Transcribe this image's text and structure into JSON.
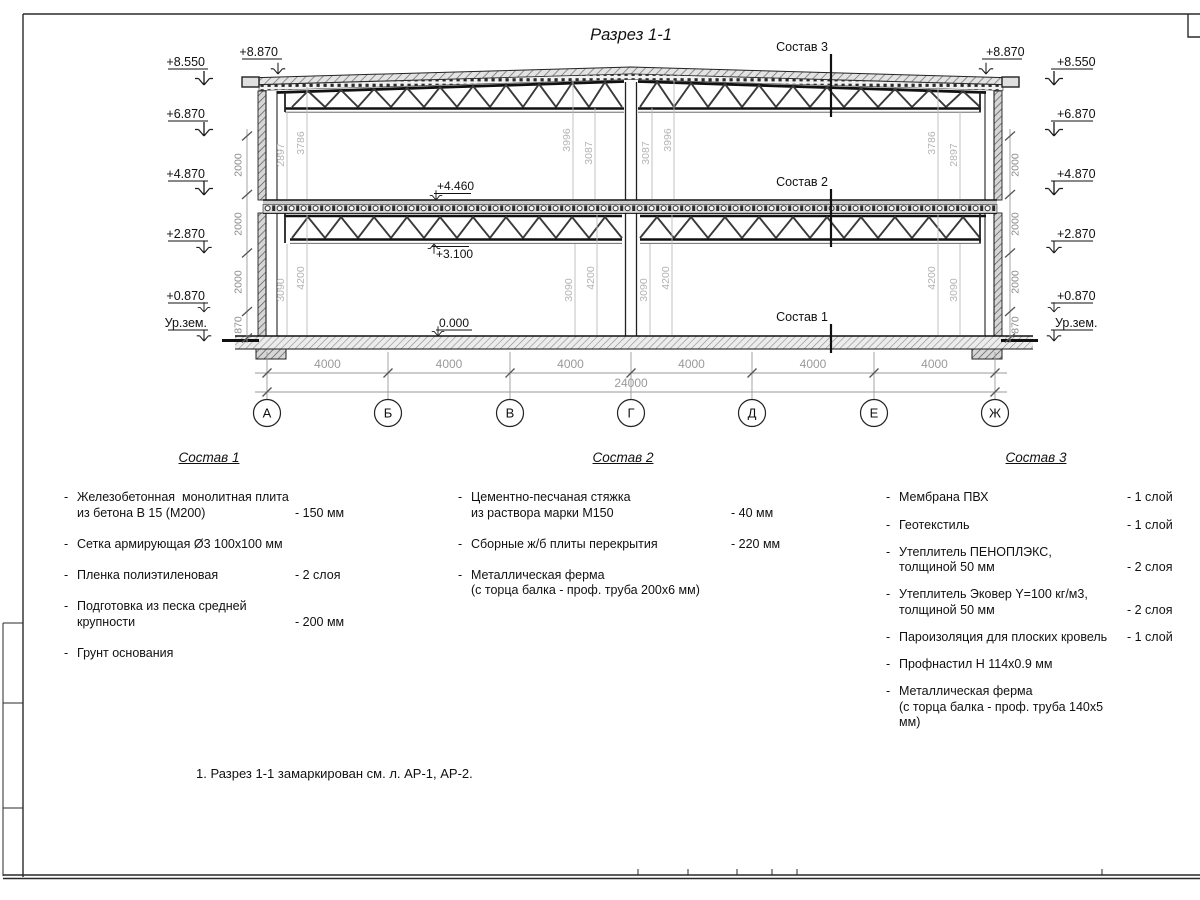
{
  "drawing": {
    "title": "Разрез 1-1",
    "leaders": {
      "s1": "Состав 1",
      "s2": "Состав 2",
      "s3": "Состав 3"
    },
    "elev": {
      "e8550": "+8.550",
      "e8870": "+8.870",
      "e6870": "+6.870",
      "e4870": "+4.870",
      "e2870": "+2.870",
      "e0870": "+0.870",
      "ground": "Ур.зем.",
      "e4460": "+4.460",
      "e3100": "+3.100",
      "e0000": "0.000"
    },
    "chain": {
      "seg2000": "2000",
      "seg870": "870"
    },
    "indims": {
      "d2897": "2897",
      "d3786": "3786",
      "d3996": "3996",
      "d3087": "3087",
      "d3090": "3090",
      "d4200": "4200"
    },
    "hdims": {
      "span": "4000",
      "total": "24000"
    },
    "axes": [
      "А",
      "Б",
      "В",
      "Г",
      "Д",
      "Е",
      "Ж"
    ]
  },
  "lists": [
    {
      "title": "Состав 1",
      "items": [
        {
          "bullet": "-",
          "text": "Железобетонная  монолитная плита\nиз бетона В 15 (М200)",
          "value": "- 150 мм"
        },
        {
          "bullet": "-",
          "text": "Сетка армирующая Ø3 100х100 мм",
          "value": ""
        },
        {
          "bullet": "-",
          "text": "Пленка полиэтиленовая",
          "value": "- 2 слоя"
        },
        {
          "bullet": "-",
          "text": "Подготовка из песка средней\nкрупности",
          "value": "- 200 мм"
        },
        {
          "bullet": "-",
          "text": "Грунт основания",
          "value": ""
        }
      ]
    },
    {
      "title": "Состав 2",
      "items": [
        {
          "bullet": "-",
          "text": "Цементно-песчаная стяжка\nиз раствора марки М150",
          "value": "- 40 мм"
        },
        {
          "bullet": "-",
          "text": "Сборные ж/б плиты перекрытия",
          "value": "- 220 мм"
        },
        {
          "bullet": "-",
          "text": "Металлическая ферма\n(с торца балка - проф. труба 200х6 мм)",
          "value": ""
        }
      ]
    },
    {
      "title": "Состав 3",
      "items": [
        {
          "bullet": "-",
          "text": "Мембрана ПВХ",
          "value": "- 1 слой"
        },
        {
          "bullet": "-",
          "text": "Геотекстиль",
          "value": "- 1 слой"
        },
        {
          "bullet": "-",
          "text": "Утеплитель ПЕНОПЛЭКС,\nтолщиной 50 мм",
          "value": "- 2 слоя"
        },
        {
          "bullet": "-",
          "text": "Утеплитель Эковер Y=100 кг/м3,\nтолщиной 50 мм",
          "value": "- 2 слоя"
        },
        {
          "bullet": "-",
          "text": "Пароизоляция для плоских кровель",
          "value": "- 1 слой"
        },
        {
          "bullet": "-",
          "text": "Профнастил Н 114х0.9 мм",
          "value": ""
        },
        {
          "bullet": "-",
          "text": "Металлическая ферма\n(с торца балка - проф. труба 140х5 мм)",
          "value": ""
        }
      ]
    }
  ],
  "note": "1. Разрез 1-1 замаркирован см. л. АР-1, АР-2."
}
